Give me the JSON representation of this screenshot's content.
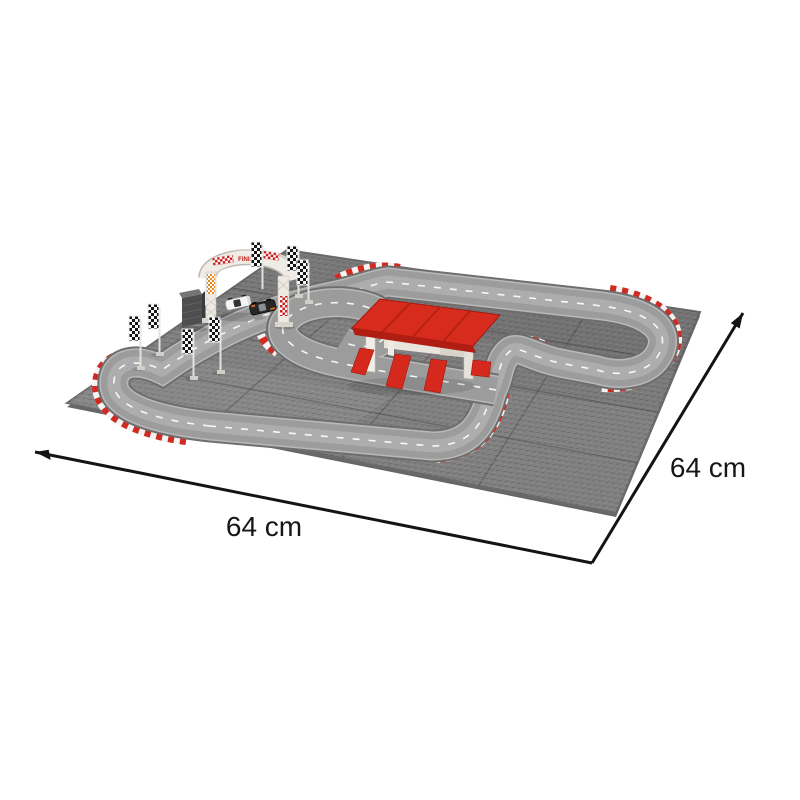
{
  "scene": {
    "type": "product-photo",
    "subject": "brick-built toy race track on gray baseplates with start gate, pit canopy and race cars",
    "background": "#ffffff",
    "dimensions": {
      "width_label": "64 cm",
      "depth_label": "64 cm"
    },
    "gate": {
      "banner_text": "FINISH"
    },
    "colors": {
      "baseplate_gray": "#818181",
      "track_gray": "#9c9c9c",
      "track_border": "#6e6e6e",
      "curb_red": "#cf2b22",
      "curb_white": "#f4f4f4",
      "roof_red": "#d62b1d",
      "structure_white": "#efece6",
      "flag_black": "#141414",
      "dimension_line": "#141414"
    }
  }
}
